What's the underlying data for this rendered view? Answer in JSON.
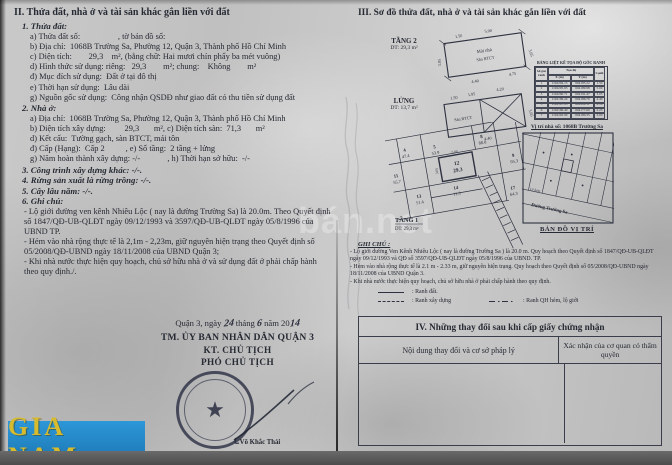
{
  "brand": "GIA NAM",
  "watermark": "bán.net",
  "colors": {
    "accent_blue": "#2d97d8",
    "accent_gold": "#d7bb2e",
    "ink": "#262a33"
  },
  "left": {
    "title": "II. Thửa đất, nhà ở và tài sản khác gắn liền với đất",
    "s1_head": "1. Thửa đất:",
    "s1": [
      "a) Thửa đất số:                  , tờ bản đồ số:",
      "b) Địa chỉ:  1068B Trường Sa, Phường 12, Quận 3, Thành phố Hồ Chí Minh",
      "c) Diện tích:        29,3    m², (bằng chữ: Hai mươi chín phẩy ba mét vuông)",
      "d) Hình thức sử dụng: riêng:   29,3        m²; chung:    Không        m²",
      "đ) Mục đích sử dụng:  Đất ở tại đô thị",
      "e) Thời hạn sử dụng:  Lâu dài",
      "g) Nguồn gốc sử dụng:  Công nhận QSDĐ như giao đất có thu tiền sử dụng đất"
    ],
    "s2_head": "2. Nhà ở:",
    "s2": [
      "a) Địa chỉ:  1068B Trường Sa, Phường 12, Quận 3, Thành phố Hồ Chí Minh",
      "b) Diện tích xây dựng:         29,3       m², c) Diện tích sàn:  71,3       m²",
      "d) Kết cấu:  Tường gạch, sàn BTCT, mái tôn",
      "đ) Cấp (Hạng):  Cấp 2          , e) Số tầng:  2 tầng + lửng",
      "g) Năm hoàn thành xây dựng: -/-             , h) Thời hạn sở hữu:  -/-"
    ],
    "s3_head": "3. Công trình xây dựng khác: -/-.",
    "s4_head": "4. Rừng sản xuất là rừng trồng: -/-.",
    "s5_head": "5. Cây lâu năm: -/-.",
    "s6_head": "6. Ghi chú:",
    "notes": [
      "- Lộ giới đường ven kênh Nhiêu Lộc ( nay là đường Trường Sa) là 20.0m. Theo Quyết định số 1847/QĐ-UB-QLĐT ngày 09/12/1993 và 3597/QĐ-UB-QLĐT ngày 05/8/1996 của UBND TP.",
      "- Hẻm vào nhà rộng thực tế là 2,1m - 2,23m, giữ nguyên hiện trạng theo Quyết định số 05/2008/QĐ-UBND ngày 18/11/2008 của UBND Quận 3;",
      "- Khi nhà nước thực hiện quy hoạch, chủ sở hữu nhà ở và sử dụng đất ở phải chấp hành theo quy định./."
    ],
    "sign": {
      "place": "Quận 3,  ngày",
      "day": "24",
      "thang": "tháng",
      "month": "6",
      "nam": "năm 20",
      "year": "14",
      "committee": "TM. ỦY BAN NHÂN DÂN QUẬN 3",
      "kt": "KT. CHỦ TỊCH",
      "role": "PHÓ CHỦ TỊCH",
      "signer": "Võ Khắc Thái"
    }
  },
  "right": {
    "title": "III. Sơ đồ thửa đất, nhà ở và tài sản khác gắn liền với đất",
    "tang2": {
      "name": "TẦNG 2",
      "area": "DT: 29,3 m²",
      "inner1": "Mái nhà",
      "inner2": "Sàn BTCT",
      "dims": [
        "1.50",
        "5.00",
        "3.05",
        "4.40",
        "4.75",
        "3.05"
      ]
    },
    "lung": {
      "name": "LỬNG",
      "area": "DT: 13,7 m²",
      "inner": "Sàn BTCT",
      "dims": [
        "1.50",
        "1.95",
        "4.20",
        "3.05",
        "4.40"
      ]
    },
    "tang1": {
      "name": "TẦNG 1",
      "area": "DT: 29,3 m²",
      "dim_top": "5.00",
      "dim_left": "3.05",
      "parcels": [
        {
          "id": "4",
          "area": "47.4"
        },
        {
          "id": "5",
          "area": "53.9"
        },
        {
          "id": "8",
          "area": "88.0"
        },
        {
          "id": "11",
          "area": "55.7"
        },
        {
          "id": "12",
          "area": "29.3"
        },
        {
          "id": "13",
          "area": "51.4"
        },
        {
          "id": "14",
          "area": "11.3"
        },
        {
          "id": "9",
          "area": "95.3"
        },
        {
          "id": "17",
          "area": "64.3"
        }
      ]
    },
    "coord_table": {
      "title": "BẢNG LIỆT KÊ TỌA ĐỘ GÓC RANH",
      "col_corner": "Số góc ranh",
      "col_coord": "Tọa độ",
      "col_x": "X (m)",
      "col_y": "Y (m)",
      "col_edge": "Cạnh",
      "rows": [
        {
          "n": "1",
          "x": "1192204.15",
          "y": "604185.22",
          "c": "1.50"
        },
        {
          "n": "2",
          "x": "1192205.63",
          "y": "604189.98",
          "c": "5.00"
        },
        {
          "n": "3",
          "x": "1192200.71",
          "y": "604191.47",
          "c": "3.05"
        },
        {
          "n": "4",
          "x": "1192199.24",
          "y": "604186.70",
          "c": "4.40"
        },
        {
          "n": "5",
          "x": "1192197.85",
          "y": "604182.11",
          "c": "2.10"
        },
        {
          "n": "6",
          "x": "1192196.40",
          "y": "604177.60",
          "c": "2.23"
        },
        {
          "n": "7",
          "x": "1192202.90",
          "y": "604180.35",
          "c": "3.00"
        }
      ]
    },
    "map": {
      "title": "Vị trí nhà số: 1068B Trường Sa",
      "street": "Đường Trường Sa",
      "alley": "Lề hẻm",
      "caption": "BẢN ĐỒ VỊ TRÍ"
    },
    "ghichu": {
      "title": "GHI CHÚ :",
      "paras": [
        "- Lộ giới đường Ven Kênh Nhiêu Lộc ( nay là đường Trường Sa ) là 20.0 m. Quy hoạch theo Quyết định số 1847/QĐ-UB-QLĐT ngày 09/12/1993 và QĐ số 3597/QĐ-UB-QLĐT ngày 05/8/1996 của UBND. TP.",
        "- Hẻm vào nhà rộng thực tế là 2.1 m - 2.33 m, giữ nguyên hiện trạng. Quy hoạch theo Quyết định số 05/2008/QĐ-UBND ngày 18/11/2008 của UBND Quận 3.",
        "- Khi nhà nước thực hiện quy hoạch, chủ sở hữu nhà ở phải chấp hành theo quy định."
      ],
      "legend": [
        {
          "label": ": Ranh đất."
        },
        {
          "label": ": Ranh xây dựng"
        },
        {
          "label": ": Ranh QH hẻm, lộ giới"
        }
      ]
    },
    "s4": {
      "title": "IV. Những thay đổi sau khi cấp giấy chứng nhận",
      "col1": "Nội dung thay đổi và cơ sở pháp lý",
      "col2": "Xác nhận của cơ quan có thẩm quyền"
    }
  }
}
